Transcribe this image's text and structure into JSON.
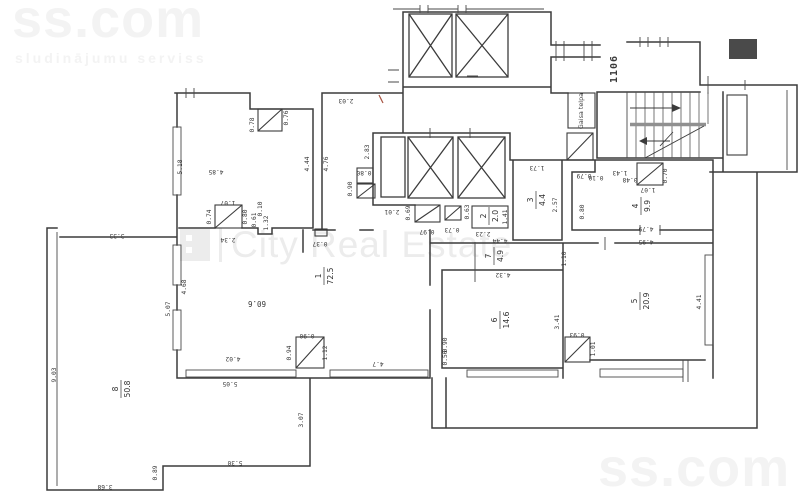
{
  "watermarks": {
    "top_left": {
      "brand": "ss.com",
      "tagline": "sludinājumu serviss"
    },
    "bottom_right": {
      "brand": "ss.com",
      "tagline": "sludinājumu serviss"
    },
    "center": {
      "text": "City Real Estate"
    }
  },
  "plan": {
    "line_color": "#3b3b3b",
    "texts": {
      "shaft_label": "1106",
      "air_space": "Gaisa telpa",
      "hall_area": "60.6"
    },
    "rooms": [
      {
        "num": "1",
        "area": "72.5",
        "x": 324,
        "y": 276
      },
      {
        "num": "2",
        "area": "2.0",
        "x": 489,
        "y": 216
      },
      {
        "num": "3",
        "area": "4.4",
        "x": 536,
        "y": 200
      },
      {
        "num": "4",
        "area": "9.9",
        "x": 641,
        "y": 206
      },
      {
        "num": "5",
        "area": "20.9",
        "x": 640,
        "y": 301
      },
      {
        "num": "6",
        "area": "14.6",
        "x": 500,
        "y": 320
      },
      {
        "num": "7",
        "area": "4.9",
        "x": 494,
        "y": 256
      },
      {
        "num": "8",
        "area": "50.8",
        "x": 121,
        "y": 389
      }
    ],
    "dims": [
      {
        "t": "0.76",
        "x": 288,
        "y": 118,
        "r": -90
      },
      {
        "t": "0.78",
        "x": 254,
        "y": 125,
        "r": -90
      },
      {
        "t": "2.03",
        "x": 346,
        "y": 99,
        "r": 180
      },
      {
        "t": "4.85",
        "x": 216,
        "y": 170,
        "r": 180
      },
      {
        "t": "5.18",
        "x": 182,
        "y": 167,
        "r": -90
      },
      {
        "t": "4.44",
        "x": 309,
        "y": 164,
        "r": -90
      },
      {
        "t": "4.76",
        "x": 328,
        "y": 164,
        "r": -90
      },
      {
        "t": "2.83",
        "x": 369,
        "y": 152,
        "r": -90
      },
      {
        "t": "1.07",
        "x": 228,
        "y": 201,
        "r": 180
      },
      {
        "t": "0.74",
        "x": 211,
        "y": 217,
        "r": -90
      },
      {
        "t": "0.80",
        "x": 247,
        "y": 217,
        "r": -90
      },
      {
        "t": "0.61",
        "x": 256,
        "y": 220,
        "r": -90
      },
      {
        "t": "0.10",
        "x": 262,
        "y": 209,
        "r": -90
      },
      {
        "t": "1.32",
        "x": 268,
        "y": 223,
        "r": -90
      },
      {
        "t": "2.34",
        "x": 228,
        "y": 238,
        "r": 180
      },
      {
        "t": "0.37",
        "x": 320,
        "y": 242,
        "r": 180
      },
      {
        "t": "0.80",
        "x": 364,
        "y": 171,
        "r": 180
      },
      {
        "t": "0.90",
        "x": 352,
        "y": 189,
        "r": -90
      },
      {
        "t": "2.01",
        "x": 392,
        "y": 210,
        "r": 180
      },
      {
        "t": "0.69",
        "x": 410,
        "y": 213,
        "r": -90
      },
      {
        "t": "0.97",
        "x": 427,
        "y": 230,
        "r": 180
      },
      {
        "t": "0.73",
        "x": 452,
        "y": 228,
        "r": 180
      },
      {
        "t": "0.63",
        "x": 469,
        "y": 212,
        "r": -90
      },
      {
        "t": "2.23",
        "x": 483,
        "y": 232,
        "r": 180
      },
      {
        "t": "1.41",
        "x": 507,
        "y": 217,
        "r": -90
      },
      {
        "t": "1.73",
        "x": 537,
        "y": 166,
        "r": 180
      },
      {
        "t": "2.57",
        "x": 557,
        "y": 205,
        "r": -90
      },
      {
        "t": "0.79",
        "x": 584,
        "y": 174,
        "r": 180
      },
      {
        "t": "0.10",
        "x": 596,
        "y": 176,
        "r": 180
      },
      {
        "t": "1.43",
        "x": 620,
        "y": 171,
        "r": 180
      },
      {
        "t": "0.48",
        "x": 630,
        "y": 178,
        "r": 180
      },
      {
        "t": "1.07",
        "x": 648,
        "y": 188,
        "r": 180
      },
      {
        "t": "0.70",
        "x": 667,
        "y": 176,
        "r": -90
      },
      {
        "t": "0.80",
        "x": 584,
        "y": 212,
        "r": -90
      },
      {
        "t": "4.79",
        "x": 646,
        "y": 227,
        "r": 180
      },
      {
        "t": "4.95",
        "x": 646,
        "y": 240,
        "r": 180
      },
      {
        "t": "4.44",
        "x": 500,
        "y": 239,
        "r": 180
      },
      {
        "t": "4.32",
        "x": 503,
        "y": 273,
        "r": 180
      },
      {
        "t": "1.10",
        "x": 566,
        "y": 259,
        "r": -90
      },
      {
        "t": "3.41",
        "x": 559,
        "y": 322,
        "r": -90
      },
      {
        "t": "0.90",
        "x": 447,
        "y": 345,
        "r": -90
      },
      {
        "t": "0.56",
        "x": 447,
        "y": 358,
        "r": -90
      },
      {
        "t": "4.41",
        "x": 701,
        "y": 302,
        "r": -90
      },
      {
        "t": "0.93",
        "x": 577,
        "y": 333,
        "r": 180
      },
      {
        "t": "1.01",
        "x": 595,
        "y": 349,
        "r": -90
      },
      {
        "t": "0.90",
        "x": 307,
        "y": 334,
        "r": 180
      },
      {
        "t": "0.94",
        "x": 291,
        "y": 353,
        "r": -90
      },
      {
        "t": "1.12",
        "x": 327,
        "y": 353,
        "r": -90
      },
      {
        "t": "4.02",
        "x": 233,
        "y": 357,
        "r": 180
      },
      {
        "t": "4.7",
        "x": 378,
        "y": 362,
        "r": 180
      },
      {
        "t": "5.05",
        "x": 230,
        "y": 382,
        "r": 180
      },
      {
        "t": "3.33",
        "x": 117,
        "y": 234,
        "r": 180
      },
      {
        "t": "9.03",
        "x": 56,
        "y": 375,
        "r": -90
      },
      {
        "t": "4.68",
        "x": 186,
        "y": 287,
        "r": -90
      },
      {
        "t": "5.07",
        "x": 170,
        "y": 309,
        "r": -90
      },
      {
        "t": "3.68",
        "x": 105,
        "y": 485,
        "r": 180
      },
      {
        "t": "0.89",
        "x": 157,
        "y": 473,
        "r": -90
      },
      {
        "t": "5.30",
        "x": 235,
        "y": 461,
        "r": 180
      },
      {
        "t": "3.07",
        "x": 303,
        "y": 420,
        "r": -90
      }
    ]
  }
}
